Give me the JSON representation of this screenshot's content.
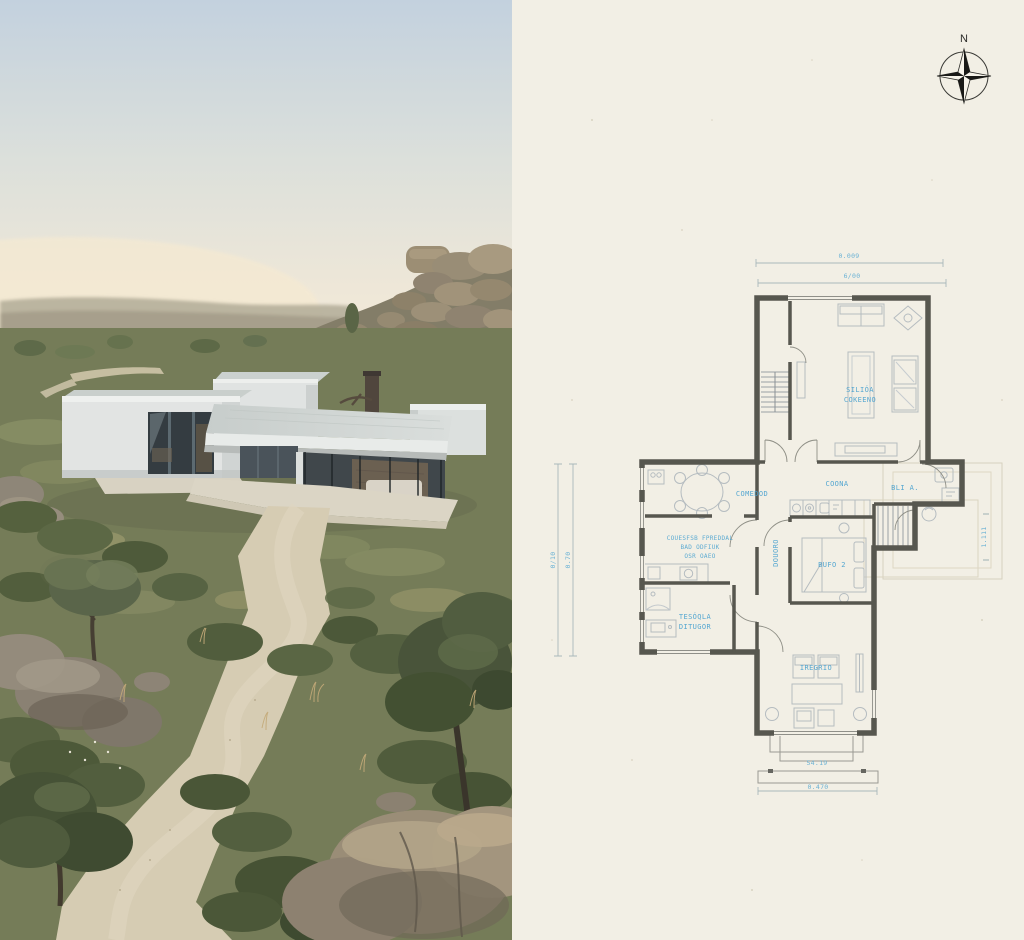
{
  "left_panel": {
    "type": "photo",
    "description": "Modern single-storey white concrete house with flat cantilevered roofs and full-height glazing, set in rocky Mediterranean scrubland with olive trees, granite boulders and a winding gravel path at dusk"
  },
  "right_panel": {
    "type": "floor-plan",
    "description": "Hand-drafted style floor plan on cream paper with blue annotations",
    "compass": {
      "label": "N"
    },
    "rooms": {
      "salon_line1": "SILIÓA",
      "salon_line2": "COKEENO",
      "comedor": "COMEDOD",
      "cocina": "COONA",
      "bano": "BLI A.",
      "dorm_line1": "COUESFSB FPREDDAL",
      "dorm_line2": "BAD ODFIUK",
      "dorm_line3": "OSR OAEO",
      "pasillo": "DOUORO",
      "dormitorio2": "BUFO 2",
      "terraza_line1": "TESÓQLA",
      "terraza_line2": "DITUGOR",
      "estudio": "IREGRIO"
    },
    "dimensions": {
      "top_outer": "0.009",
      "top_inner": "6/00",
      "left_outer": "0/10",
      "left_inner": "0.70",
      "right_side": "1.111",
      "porch": "54.19",
      "bottom": "0.470"
    },
    "colors": {
      "paper": "#f2efe5",
      "wall": "#57574f",
      "label_blue": "#45a0cf",
      "furniture": "#b5bcc0",
      "dim_line": "#a9b8ba"
    }
  }
}
